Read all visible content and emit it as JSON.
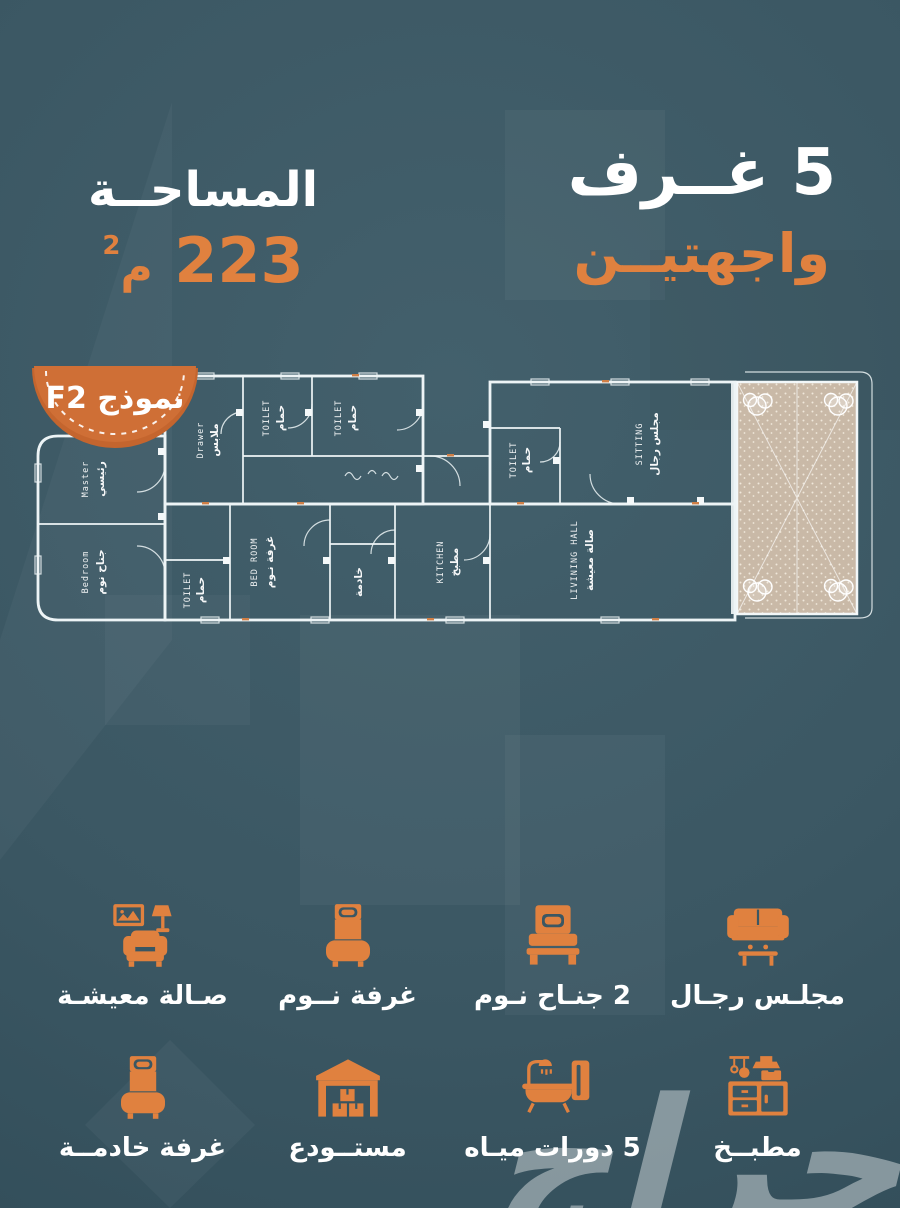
{
  "header": {
    "rooms_line": "5 غــرف",
    "facades_line": "واجهتيــن",
    "area_label": "المساحــة",
    "area_value": "223",
    "area_unit": "م",
    "area_sup": "2"
  },
  "plan": {
    "badge": "نموذج F2",
    "labels": [
      {
        "en": "Master",
        "ar": "رئيسي"
      },
      {
        "en": "Bedroom",
        "ar": "جناح نوم"
      },
      {
        "en": "Drawer",
        "ar": "ملابس"
      },
      {
        "en": "TOILET",
        "ar": "حمام"
      },
      {
        "en": "TOILET",
        "ar": "حمام"
      },
      {
        "en": "TOILET",
        "ar": "حمام"
      },
      {
        "en": "BED ROOM",
        "ar": "غرفة نـوم"
      },
      {
        "en": "",
        "ar": "خادمة"
      },
      {
        "en": "KITCHEN",
        "ar": "مطبخ"
      },
      {
        "en": "TOILET",
        "ar": "حمام"
      },
      {
        "en": "SITTING",
        "ar": "مجلس رجال"
      },
      {
        "en": "LIVINING HALL",
        "ar": "صالة معيشة"
      }
    ]
  },
  "features": [
    {
      "icon": "sofa-icon",
      "label": "مجلـس رجـال"
    },
    {
      "icon": "double-bed-icon",
      "label": "2 جنـاح نـوم"
    },
    {
      "icon": "single-bed-icon",
      "label": "غرفة نــوم"
    },
    {
      "icon": "armchair-icon",
      "label": "صـالة معيشـة"
    },
    {
      "icon": "kitchen-icon",
      "label": "مطبــخ"
    },
    {
      "icon": "bathtub-icon",
      "label": "5 دورات ميـاه"
    },
    {
      "icon": "warehouse-icon",
      "label": "مستــودع"
    },
    {
      "icon": "maid-bed-icon",
      "label": "غرفة خادمــة"
    }
  ],
  "watermark": "حراج",
  "colors": {
    "accent_orange": "#E0813F",
    "badge_orange": "#CF6F36",
    "background_teal": "#3B5763",
    "text_white": "#FFFFFF",
    "terrace_beige": "#C9B9A7"
  }
}
